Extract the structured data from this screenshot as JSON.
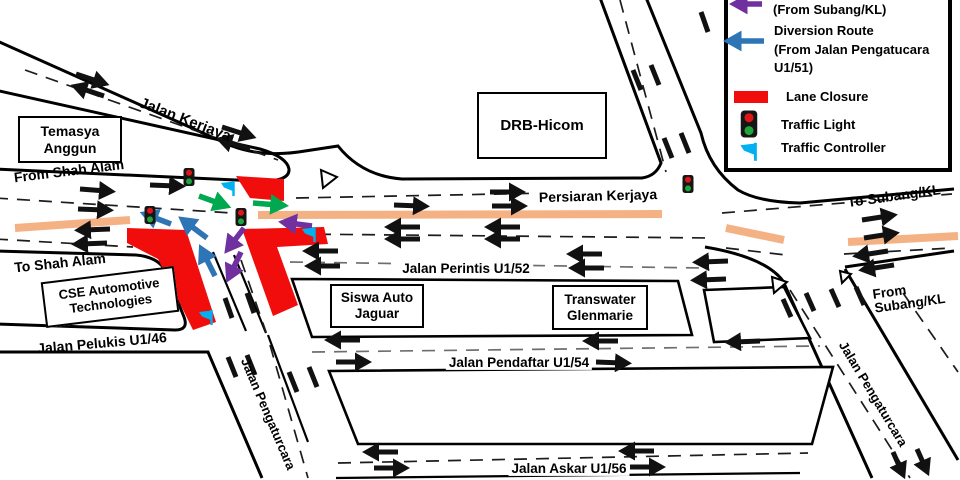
{
  "colors": {
    "red": "#f20d0d",
    "tan": "#f4b183",
    "purple": "#7030a0",
    "blue": "#2e75b6",
    "green": "#00a94f",
    "cyan": "#00b0f0"
  },
  "legend": {
    "row1_line1": "(From Subang/KL)",
    "row2_line1": "Diversion Route",
    "row2_line2": "(From Jalan Pengatucara",
    "row2_line3": "U1/51)",
    "row3": "Lane Closure",
    "row4": "Traffic Light",
    "row5": "Traffic Controller"
  },
  "places": {
    "temasya_line1": "Temasya",
    "temasya_line2": "Anggun",
    "drb": "DRB-Hicom",
    "cse_line1": "CSE Automotive",
    "cse_line2": "Technologies",
    "siswa_line1": "Siswa Auto",
    "siswa_line2": "Jaguar",
    "trans_line1": "Transwater",
    "trans_line2": "Glenmarie"
  },
  "roads": {
    "kerjaya": "Jalan Kerjaya",
    "from_shah_alam": "From Shah Alam",
    "to_shah_alam": "To Shah Alam",
    "persiaran_kerjaya": "Persiaran Kerjaya",
    "perintis": "Jalan Perintis U1/52",
    "pelukis": "Jalan Pelukis U1/46",
    "pendaftar": "Jalan Pendaftar U1/54",
    "askar": "Jalan Askar U1/56",
    "pengaturcara_left": "Jalan Pengaturcara",
    "pengaturcara_right": "Jalan Pengaturcara",
    "to_subang": "To Subang/KL",
    "from_subang_line1": "From",
    "from_subang_line2": "Subang/KL"
  },
  "icons": {
    "traffic_light": "traffic-light-icon",
    "traffic_controller": "traffic-controller-flag-icon",
    "lane_closure": "lane-closure-red-bar",
    "diversion_from_subang": "purple-arrow-icon",
    "diversion_from_pengatucara": "blue-arrow-icon",
    "give_way": "yield-triangle-icon"
  }
}
